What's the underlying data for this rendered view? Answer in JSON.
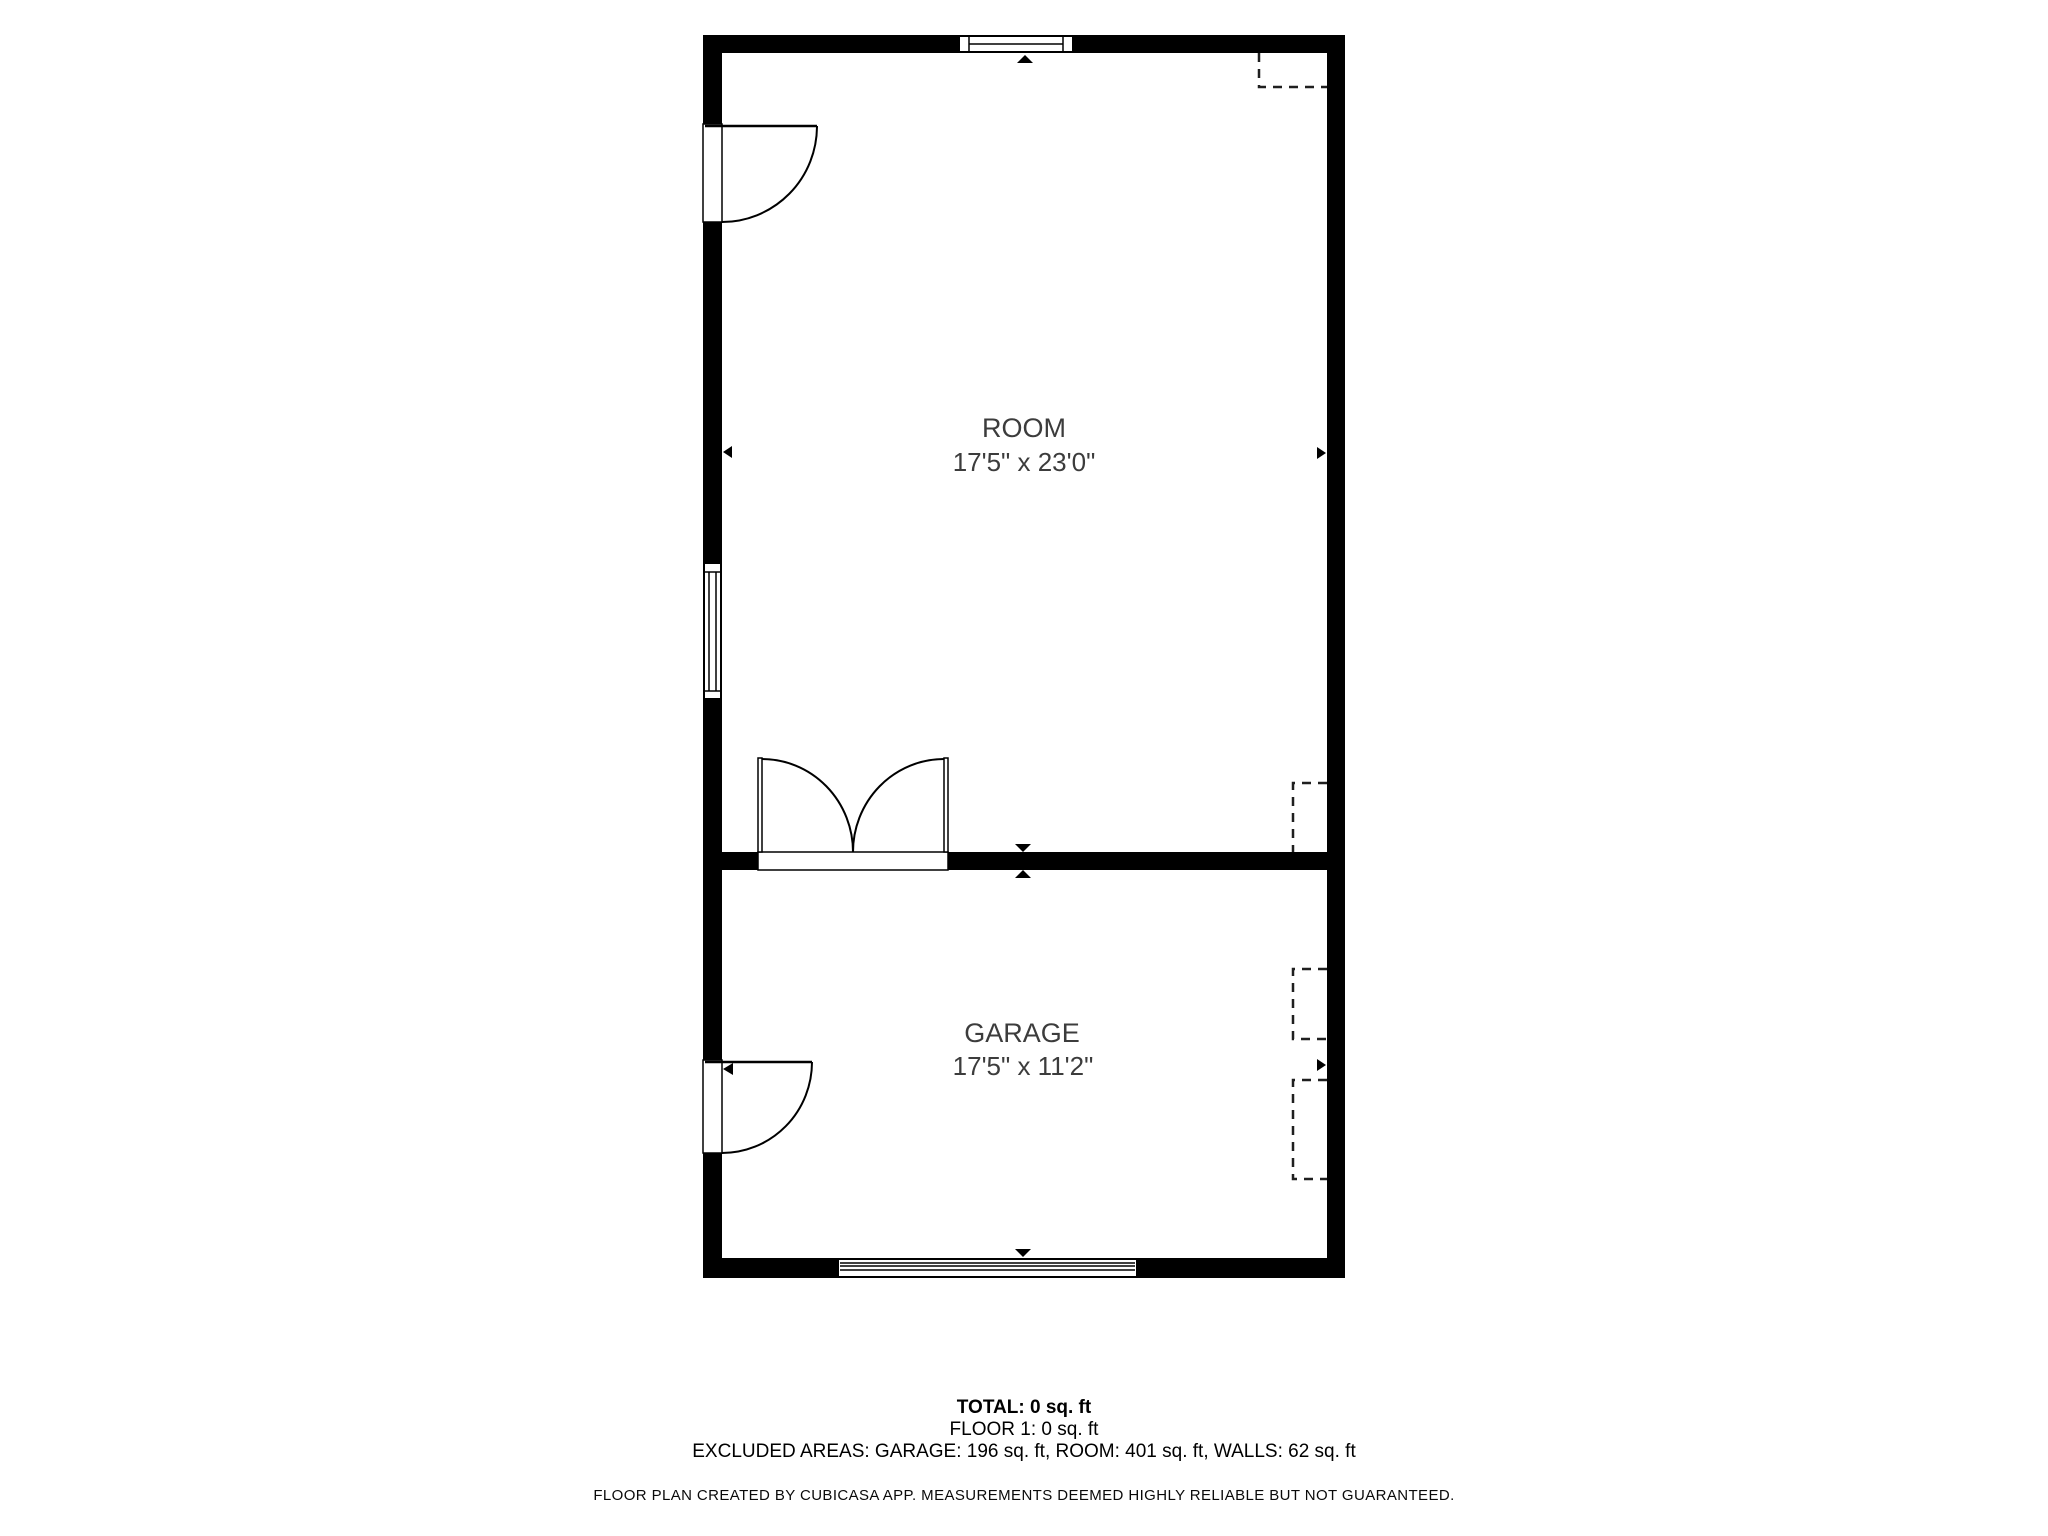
{
  "rooms": [
    {
      "id": "room",
      "name": "ROOM",
      "dimensions": "17'5\" x 23'0\""
    },
    {
      "id": "garage",
      "name": "GARAGE",
      "dimensions": "17'5\" x 11'2\""
    }
  ],
  "summary": {
    "total": "TOTAL: 0 sq. ft",
    "floor": "FLOOR 1: 0 sq. ft",
    "excluded": "EXCLUDED AREAS: GARAGE: 196 sq. ft, ROOM: 401 sq. ft, WALLS: 62 sq. ft",
    "disclaimer": "FLOOR PLAN CREATED BY CUBICASA APP. MEASUREMENTS DEEMED HIGHLY RELIABLE BUT NOT GUARANTEED."
  },
  "icons": {
    "direction_marker": "small solid triangle",
    "door_symbol": "quarter-circle swing arc",
    "window_symbol": "double-line glazing bar",
    "garage_door_symbol": "striped band",
    "dashed_feature": "dashed open rectangle"
  },
  "colors": {
    "wall": "#000000",
    "label_text": "#3c3c3c",
    "summary_text": "#000000",
    "background": "#ffffff"
  }
}
